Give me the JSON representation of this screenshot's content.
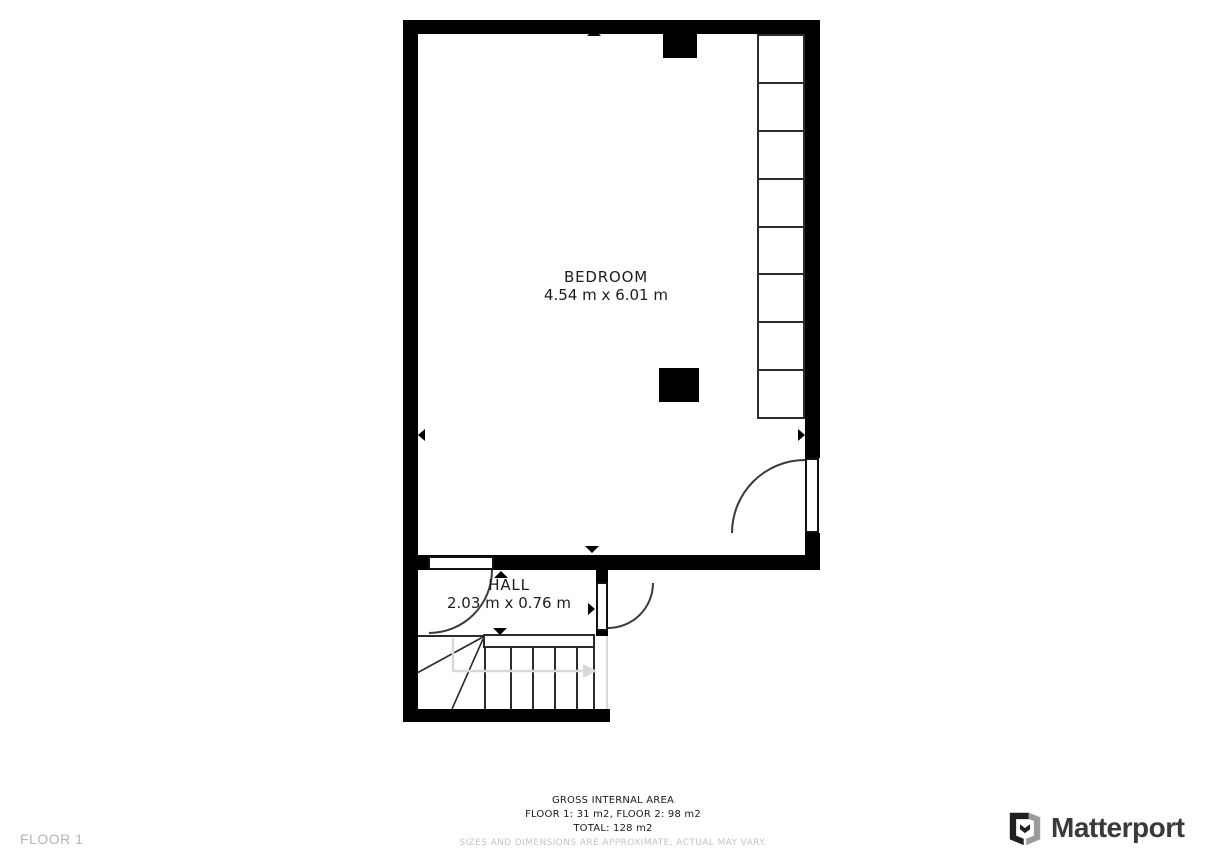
{
  "plan": {
    "rooms": [
      {
        "name": "BEDROOM",
        "dims": "4.54 m x 6.01 m"
      },
      {
        "name": "HALL",
        "dims": "2.03 m x 0.76 m"
      }
    ],
    "markers": {
      "bedroom": [
        "up",
        "down",
        "left",
        "right"
      ],
      "hall": [
        "up",
        "down",
        "left",
        "right"
      ],
      "stairs_direction": "right"
    },
    "footer": {
      "floor_label": "FLOOR 1",
      "area_title": "GROSS INTERNAL AREA",
      "area_floors": "FLOOR 1: 31 m2, FLOOR 2: 98 m2",
      "area_total": "TOTAL: 128 m2",
      "disclaimer": "SIZES AND DIMENSIONS ARE APPROXIMATE, ACTUAL MAY VARY."
    },
    "branding": {
      "name": "Matterport"
    },
    "colors": {
      "wall": "#000000",
      "outline": "#2b2b2b",
      "label_text": "#1c1c1c",
      "muted_text": "#b5b5b5",
      "disclaimer_text": "#c4c4c4",
      "stair_arrow": "#d9d9d9",
      "logo_dark": "#1f1f22",
      "logo_gray": "#9b9b9b",
      "logo_text": "#3a3a3e"
    }
  }
}
